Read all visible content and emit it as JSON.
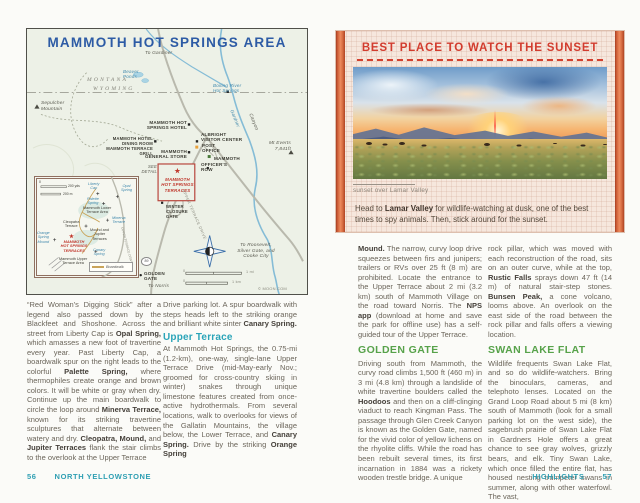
{
  "colors": {
    "map_title_blue": "#2d5ba5",
    "terrace_red": "#c0392e",
    "callout_red": "#d23c2e",
    "teal_heading": "#2aa4b8",
    "green_heading": "#57a24a",
    "footer_teal": "#2f9fb3",
    "water_blue": "#4189ad",
    "bar_orange": "#d96f44"
  },
  "icons": {
    "star": "★",
    "triangle": "▲"
  },
  "left_page": {
    "map": {
      "title": "MAMMOTH HOT SPRINGS AREA",
      "labels": {
        "to_gardiner": "To Gardiner",
        "montana": "MONTANA",
        "wyoming": "WYOMING",
        "sepulcher": "Sepulcher\nMountain",
        "beaver_ponds": "Beaver\nPonds",
        "boiling_river": "Boiling River\nHot Springs",
        "gardner": "Gardner",
        "canyon": "Canyon",
        "mt_everts": "Mt Everts\n7,841ft",
        "hotel": "MAMMOTH HOT\nSPRINGS HOTEL",
        "dining": "MAMMOTH HOTEL DINING ROOM\nMAMMOTH TERRACE GRILL",
        "store": "MAMMOTH\nGENERAL STORE",
        "visitor": "ALBRIGHT\nVISITOR CENTER",
        "post": "POST\nOFFICE",
        "mammoth": "MAMMOTH",
        "officers": "OFFICER'S\nROW",
        "see_detail": "SEE\nDETAIL",
        "terraces": "MAMMOTH\nHOT SPRINGS\nTERRACES",
        "winter_gate": "WINTER\nCLOSURE\nGATE",
        "upper_terrace_drive": "UPPER TERRACE DRIVE",
        "golden_gate": "GOLDEN\nGATE",
        "to_norris": "To Norris",
        "to_roosevelt": "To Roosevelt,\nSilver Gate, and\nCooke City",
        "route_89": "89",
        "scale_zero": "0",
        "scale_mi": "1 mi",
        "scale_km": "1 km",
        "copyright": "© MOON.COM"
      },
      "inset": {
        "scale_zero": "0",
        "scale_yds": "200 yds",
        "scale_m": "200 m",
        "liberty_cap": "Liberty\nCap",
        "opal": "Opal\nSpring",
        "palette": "Palette\nSpring",
        "lower_area": "Mammoth Lower\nTerrace Area",
        "cleopatra": "Cleopatra\nTerrace",
        "minerva": "Minerva\nTerrace",
        "mound_jupiter": "Mound and\nJupiter\nTerraces",
        "canary": "Canary\nSpring",
        "orange_mound": "Orange\nSpring\nMound",
        "terraces": "MAMMOTH\nHOT SPRINGS\nTERRACES",
        "upper_area": "Mammoth Upper\nTerrace Area",
        "boardwalk": "Boardwalk"
      }
    },
    "columns": {
      "col1": [
        {
          "t": "“Red Woman’s Digging Stick” after a legend also passed down by the Blackfeet and Shoshone. Across the street from Liberty Cap is "
        },
        {
          "t": "Opal Spring,",
          "b": true
        },
        {
          "t": " which amasses a new foot of travertine every year. Past Liberty Cap, a boardwalk spur on the right leads to the colorful "
        },
        {
          "t": "Palette Spring,",
          "b": true
        },
        {
          "t": " where thermophiles create orange and brown colors. It will be white or gray when dry. Continue up the main boardwalk to circle the loop around "
        },
        {
          "t": "Minerva Terrace,",
          "b": true
        },
        {
          "t": " known for its striking travertine sculptures that alternate between watery and dry. "
        },
        {
          "t": "Cleopatra, Mound,",
          "b": true
        },
        {
          "t": " and "
        },
        {
          "t": "Jupiter Terraces",
          "b": true
        },
        {
          "t": " flank the stair climbs to the overlook at the Upper Terrace"
        }
      ],
      "col2a": [
        {
          "t": "Drive parking lot. A spur boardwalk with steps heads left to the striking orange and brilliant white sinter "
        },
        {
          "t": "Canary Spring.",
          "b": true
        }
      ],
      "heading2": "Upper Terrace",
      "col2b": [
        {
          "t": "At Mammoth Hot Springs, the 0.75-mi (1.2-km), one-way, single-lane Upper Terrace Drive (mid-May-early Nov.; groomed for cross-country skiing in winter) snakes through unique limestone features created from once-active hydrothermals. From several locations, walk to overlooks for views of the Gallatin Mountains, the village below, the Lower Terrace, and "
        },
        {
          "t": "Canary Spring.",
          "b": true
        },
        {
          "t": " Drive by the striking "
        },
        {
          "t": "Orange Spring",
          "b": true
        }
      ]
    },
    "footer": {
      "page_number": "56",
      "section": "NORTH YELLOWSTONE"
    }
  },
  "right_page": {
    "callout": {
      "title": "BEST PLACE TO WATCH THE SUNSET",
      "photo_caption": "sunset over Lamar Valley",
      "body": [
        {
          "t": "Head to "
        },
        {
          "t": "Lamar Valley",
          "b": true
        },
        {
          "t": " for wildlife-watching at dusk, one of the best times to spy animals. Then, stick around for the sunset."
        }
      ]
    },
    "columns": {
      "col1a": [
        {
          "t": "Mound.",
          "b": true
        },
        {
          "t": " The narrow, curvy loop drive squeezes between firs and junipers; trailers or RVs over 25 ft (8 m) are prohibited. Locate the entrance to the Upper Terrace about 2 mi (3.2 km) south of Mammoth Village on the road toward Norris. The "
        },
        {
          "t": "NPS app",
          "b": true
        },
        {
          "t": " (download at home and save the park for offline use) has a self-guided tour of the Upper Terrace."
        }
      ],
      "heading1": "GOLDEN GATE",
      "col1b": [
        {
          "t": "Driving south from Mammoth, the curvy road climbs 1,500 ft (460 m) in 3 mi (4.8 km) through a landslide of white travertine boulders called the "
        },
        {
          "t": "Hoodoos",
          "b": true
        },
        {
          "t": " and then on a cliff-clinging viaduct to reach Kingman Pass. The passage through Glen Creek Canyon is known as the Golden Gate, named for the vivid color of yellow lichens on the rhyolite cliffs. While the road has been rebuilt several times, its first incarnation in 1884 was a rickety wooden trestle bridge. A unique"
        }
      ],
      "col2a": [
        {
          "t": "rock pillar, which was moved with each reconstruction of the road, sits on an outer curve, while at the top, "
        },
        {
          "t": "Rustic Falls",
          "b": true
        },
        {
          "t": " sprays down 47 ft (14 m) of natural stair-step stones. "
        },
        {
          "t": "Bunsen Peak,",
          "b": true
        },
        {
          "t": " a cone volcano, looms above. An overlook on the east side of the road between the rock pillar and falls offers a viewing location."
        }
      ],
      "heading2": "SWAN LAKE FLAT",
      "col2b": [
        {
          "t": "Wildlife frequents Swan Lake Flat, and so do wildlife-watchers. Bring the binoculars, cameras, and telephoto lenses. Located on the Grand Loop Road about 5 mi (8 km) south of Mammoth (look for a small parking lot on the west side), the sagebrush prairie of Swan Lake Flat in Gardners Hole offers a great chance to see gray wolves, grizzly bears, and elk. Tiny Swan Lake, which once filled the entire flat, has housed nesting trumpeter swans in summer, along with other waterfowl. The vast,"
        }
      ]
    },
    "footer": {
      "section": "HIGHLIGHTS",
      "page_number": "57"
    }
  }
}
